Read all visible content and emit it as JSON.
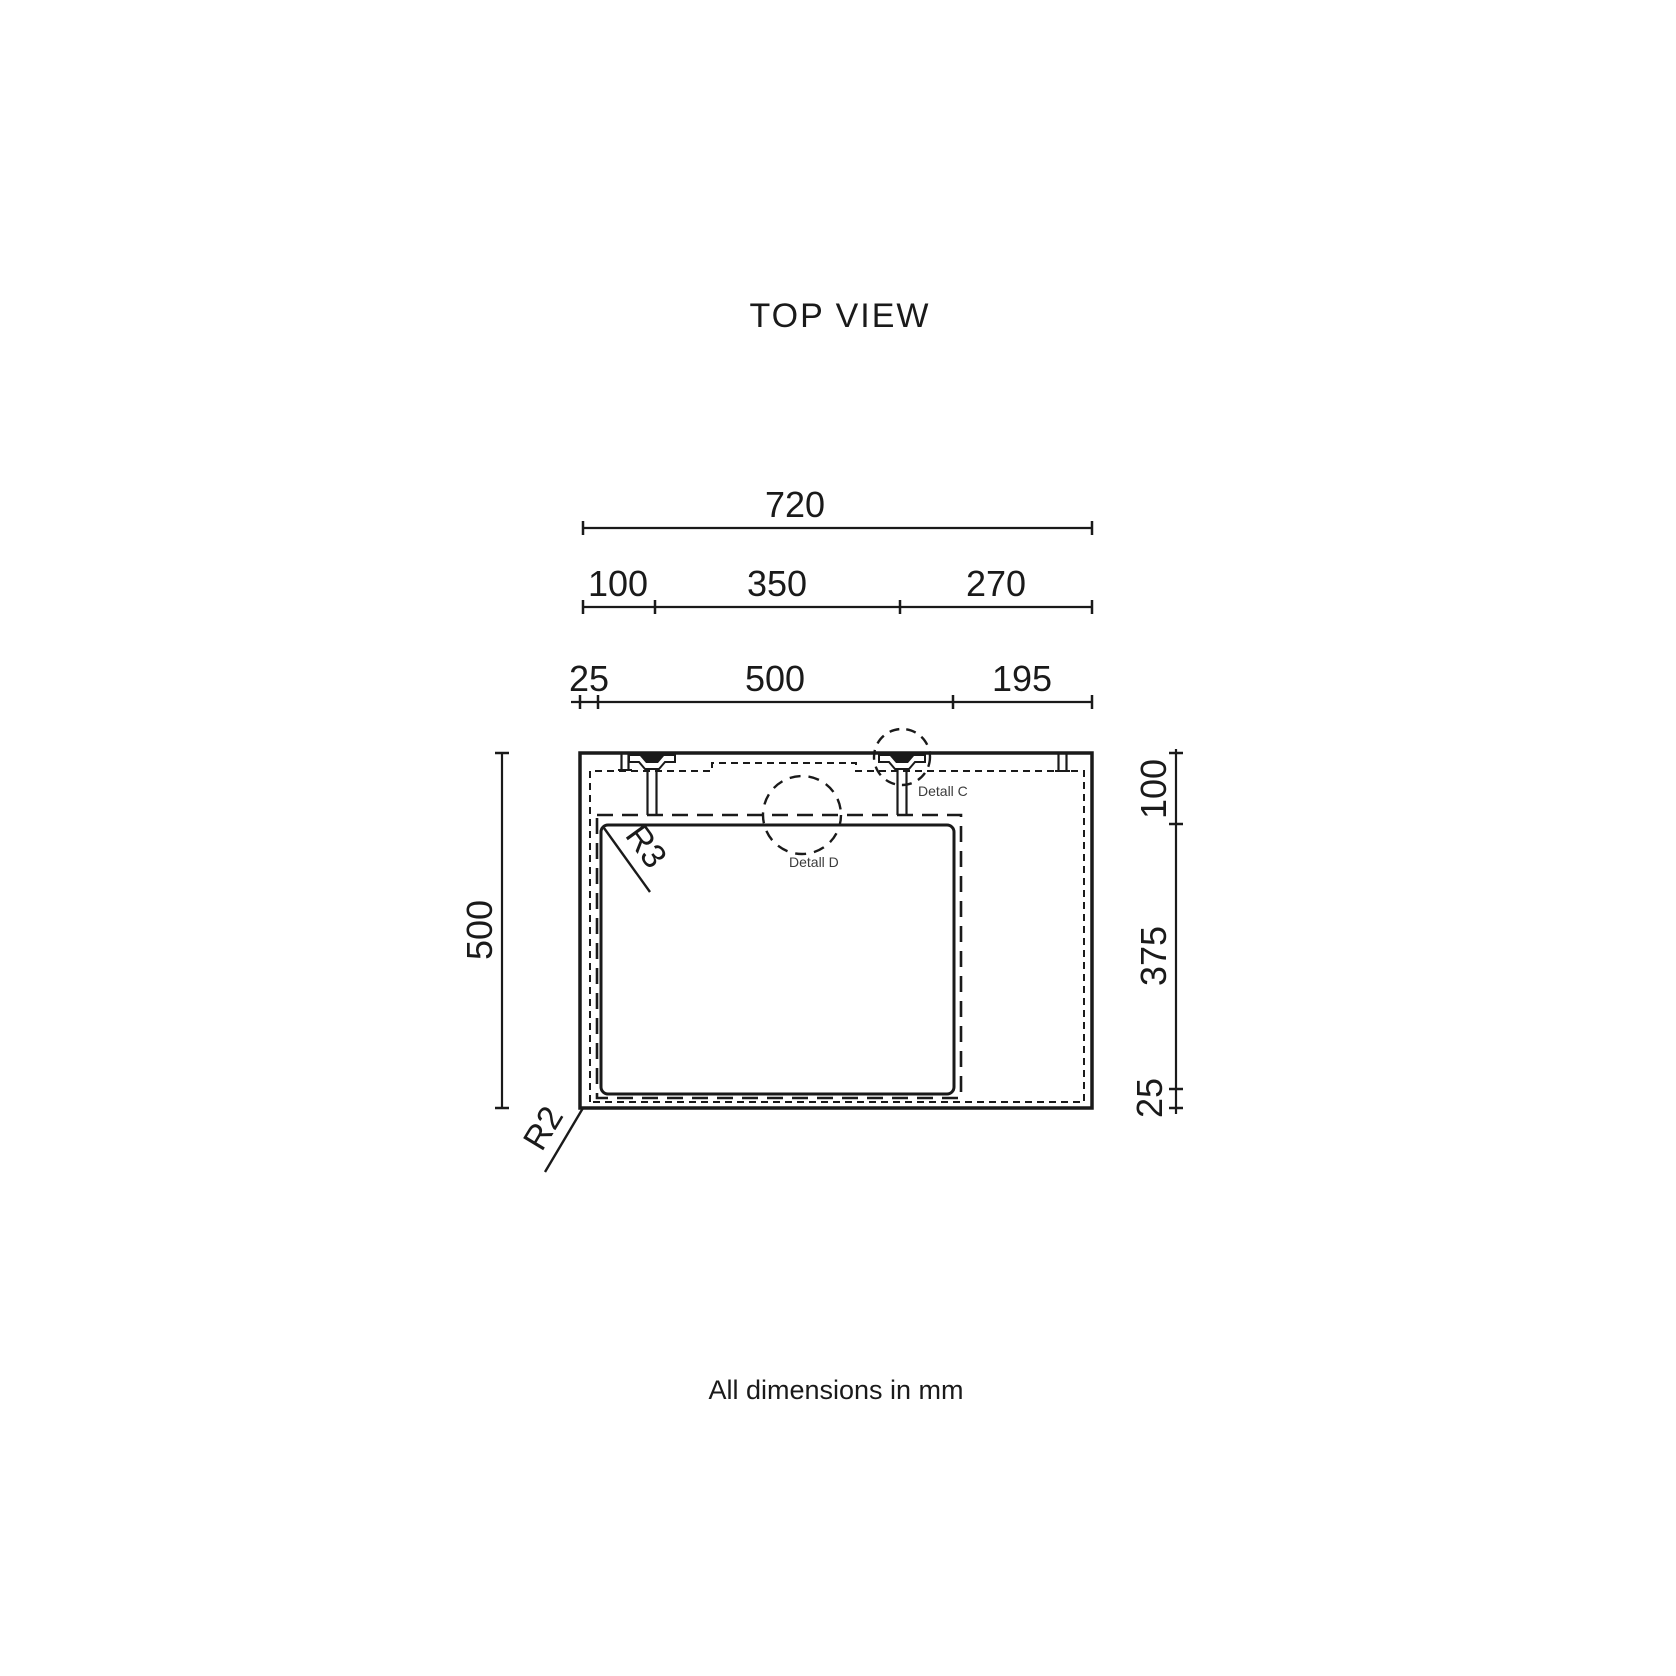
{
  "title": "TOP VIEW",
  "note": "All dimensions in mm",
  "units": "mm",
  "colors": {
    "line": "#1a1a1a",
    "detail_label": "#3c3c3c",
    "background": "#ffffff"
  },
  "dimensions": {
    "top_total": {
      "label": "720",
      "value": 720
    },
    "top_segments": [
      {
        "label": "100",
        "value": 100
      },
      {
        "label": "350",
        "value": 350
      },
      {
        "label": "270",
        "value": 270
      }
    ],
    "cavity_segments": [
      {
        "label": "25",
        "value": 25
      },
      {
        "label": "500",
        "value": 500
      },
      {
        "label": "195",
        "value": 195
      }
    ],
    "left": {
      "label": "500",
      "value": 500
    },
    "right": [
      {
        "label": "100",
        "value": 100
      },
      {
        "label": "375",
        "value": 375
      },
      {
        "label": "25",
        "value": 25
      }
    ]
  },
  "details": [
    {
      "label": "Detall C"
    },
    {
      "label": "Detall D"
    }
  ],
  "radii": [
    {
      "label": "R3",
      "value": 3
    },
    {
      "label": "R2",
      "value": 2
    }
  ]
}
